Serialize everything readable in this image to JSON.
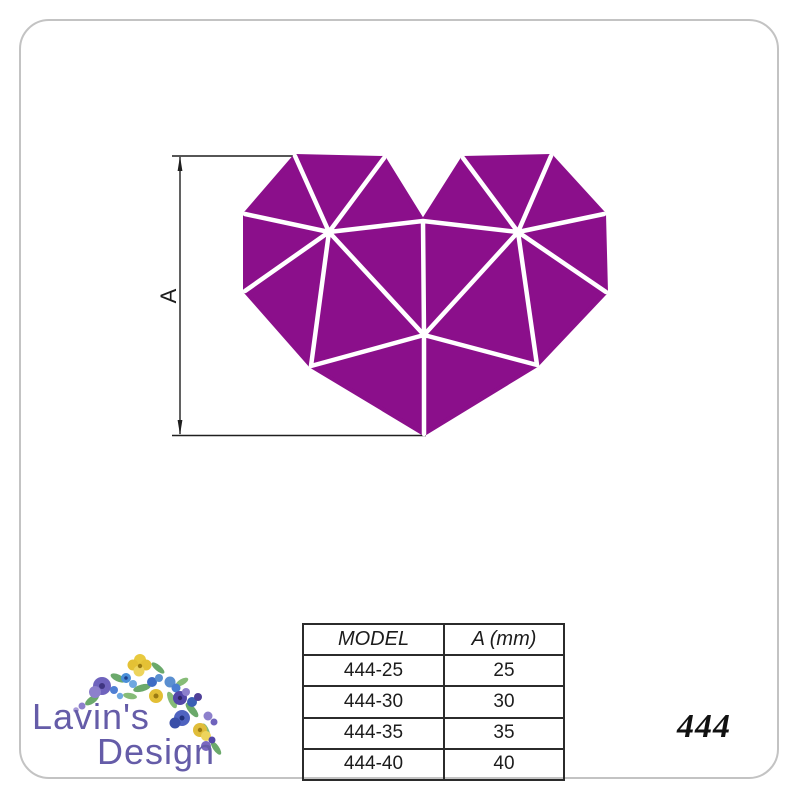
{
  "page": {
    "background_color": "#ffffff",
    "frame_border_color": "#c3c3c3"
  },
  "drawing": {
    "dimension_label": "A",
    "heart_color": "#8B0F8B",
    "facet_line_color": "#ffffff",
    "dim_line_color": "#1f1f1f"
  },
  "table": {
    "headers": [
      "MODEL",
      "A (mm)"
    ],
    "rows": [
      {
        "model": "444-25",
        "a_mm": "25"
      },
      {
        "model": "444-30",
        "a_mm": "30"
      },
      {
        "model": "444-35",
        "a_mm": "35"
      },
      {
        "model": "444-40",
        "a_mm": "40"
      }
    ]
  },
  "logo": {
    "line1": "Lavin's",
    "line2": "Design",
    "text_color": "#655CA8"
  },
  "model_number": "444"
}
